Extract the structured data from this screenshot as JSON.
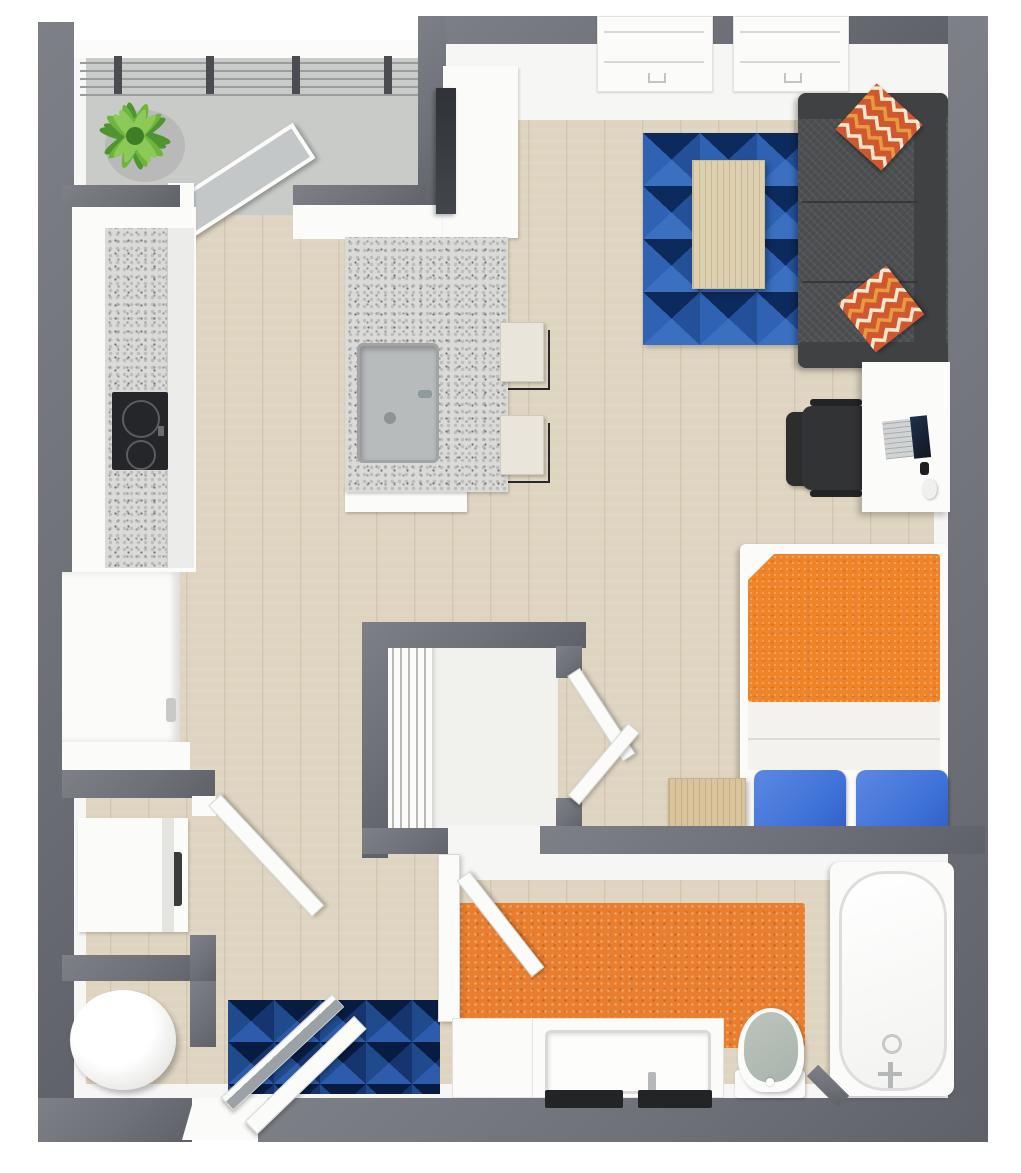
{
  "meta": {
    "title": "3D top-down floor plan render — studio apartment",
    "view": "top-down-3d",
    "visible_text": "none"
  },
  "palette": {
    "wall": "#6e7178",
    "wall_lt": "#7d8086",
    "wall_dk": "#5e6168",
    "inner_face": "#f6f6f4",
    "wood_floor": "#ded4c0",
    "balcony_floor": "#c9cbc9",
    "closet_floor": "#f1f1ee",
    "rug_base": "#1a4080",
    "rug_dark": "#0d2a5c",
    "rug_mid": "#245099",
    "rug_light": "#3a70bf",
    "rug_lighter": "#2f62b2",
    "entry_rug_base": "#10295a",
    "entry_rug_dark": "#081c42",
    "entry_rug_mid": "#1f4a8c",
    "entry_rug_light": "#2c5cab",
    "accent_orange": "#e87e2e",
    "bed_orange": "#ee8327",
    "pillow_blue": "#3f72d8",
    "sofa_gray": "#4d4f50",
    "sofa_dark": "#3f4142",
    "chevron_red": "#d1572f",
    "chevron_cream": "#f3e8cd",
    "chevron_amber": "#e59b40",
    "wood_furniture": "#d9c49e",
    "granite": "#dadad8",
    "steel": "#b7bbbc",
    "fixture_white": "#fbfbfa",
    "appliance_black": "#2b2d2f",
    "toilet_lid": "#a9b3ac",
    "glass": "#c3c7c8",
    "plant_green_dark": "#4f9430",
    "plant_green_mid": "#6fb53d",
    "plant_green_light": "#8cc957"
  },
  "rooms": [
    {
      "name": "balcony",
      "fixtures": [
        "potted-plant",
        "railing",
        "sliding-glass-door"
      ]
    },
    {
      "name": "kitchen",
      "fixtures": [
        "granite-counter",
        "cooktop",
        "refrigerator",
        "tall-cabinet",
        "tv-panel",
        "peninsula-island",
        "sink",
        "bar-stool",
        "bar-stool"
      ]
    },
    {
      "name": "living-area",
      "fixtures": [
        "window",
        "window",
        "geometric-blue-rug",
        "coffee-table",
        "sectional-sofa",
        "chevron-pillow",
        "chevron-pillow",
        "desk",
        "office-chair",
        "laptop",
        "mouse"
      ]
    },
    {
      "name": "sleeping-area",
      "fixtures": [
        "double-bed",
        "orange-comforter",
        "blue-pillow",
        "blue-pillow",
        "nightstand"
      ]
    },
    {
      "name": "walk-in-closet",
      "fixtures": [
        "slatted-organizer",
        "double-doors"
      ]
    },
    {
      "name": "laundry-closet",
      "fixtures": [
        "washer-dryer",
        "door"
      ]
    },
    {
      "name": "utility-closet",
      "fixtures": [
        "water-heater",
        "door"
      ]
    },
    {
      "name": "entry",
      "fixtures": [
        "geometric-blue-entry-rug",
        "entry-door",
        "closet-door"
      ]
    },
    {
      "name": "bathroom",
      "fixtures": [
        "orange-bath-rug",
        "vanity",
        "sink",
        "toilet",
        "bathtub",
        "door"
      ]
    }
  ]
}
